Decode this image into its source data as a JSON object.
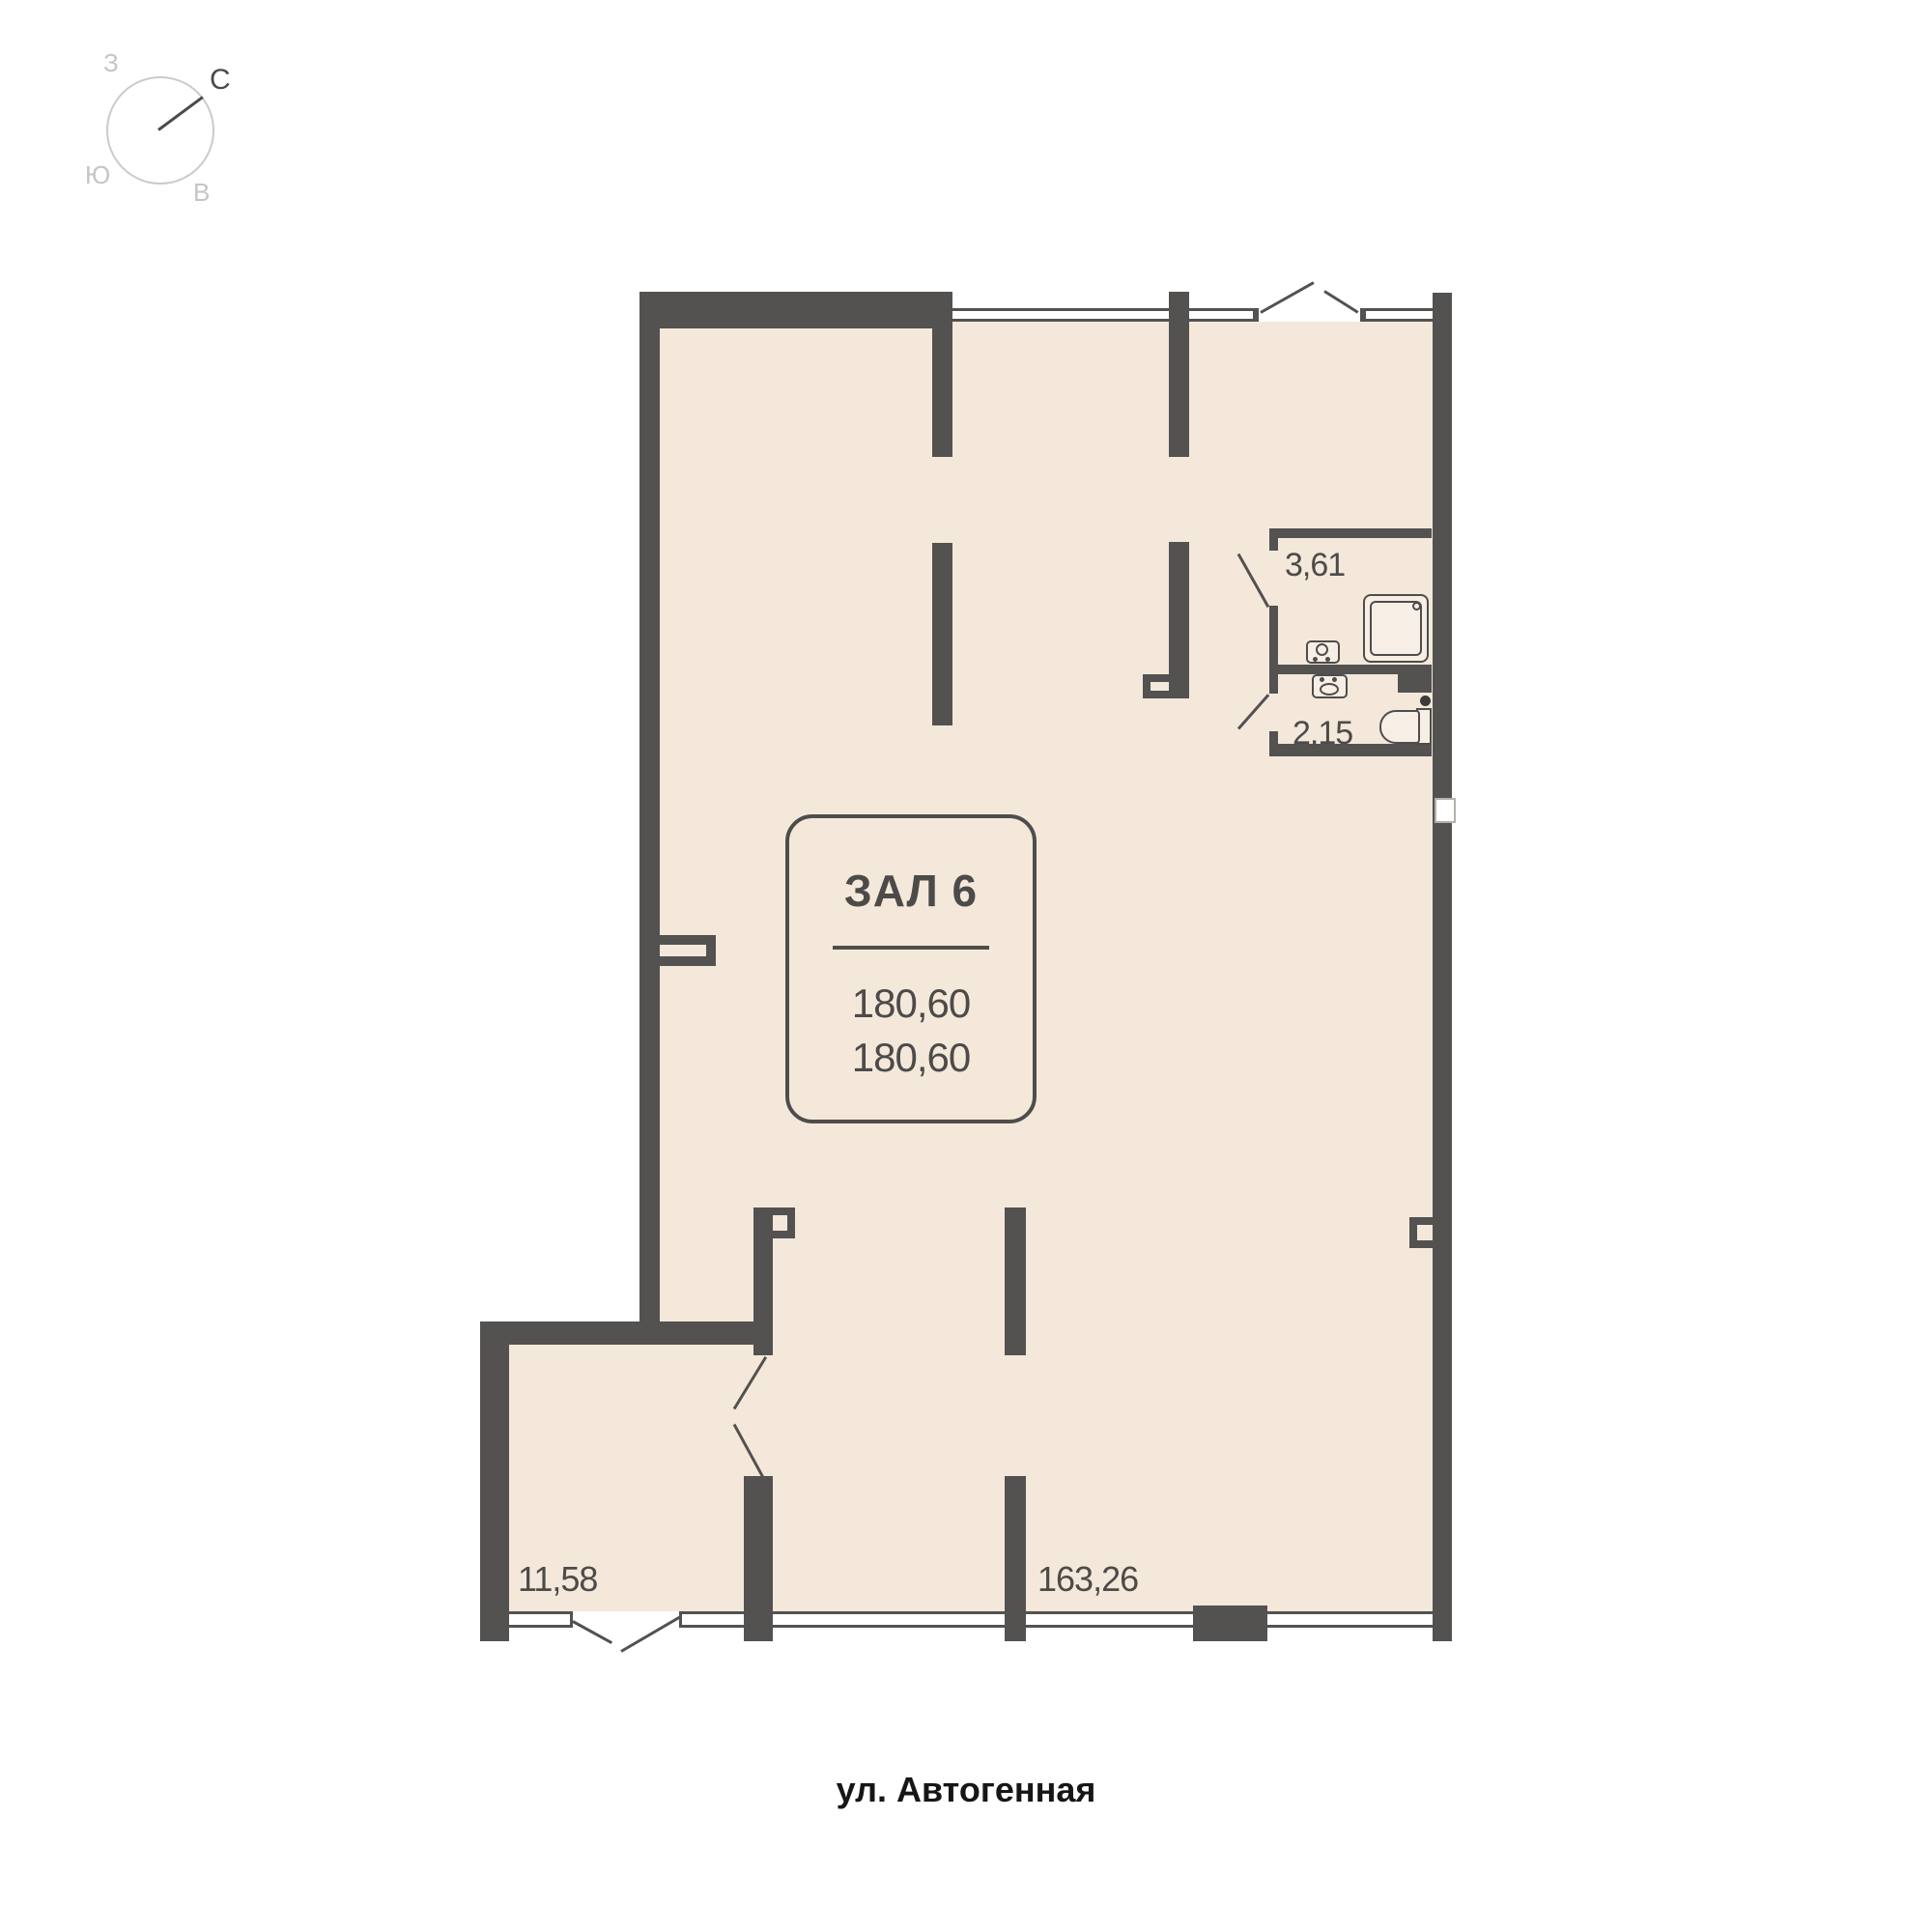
{
  "compass": {
    "north_label": "С",
    "west_label": "З",
    "south_label": "Ю",
    "east_label": "В"
  },
  "unit_card": {
    "title": "ЗАЛ 6",
    "area_line1": "180,60",
    "area_line2": "180,60"
  },
  "areas": {
    "bathroom": "3,61",
    "wc": "2,15",
    "entry_room": "11,58",
    "main_hall": "163,26"
  },
  "street": {
    "name": "ул. Автогенная"
  },
  "colors": {
    "wall": "#535251",
    "floor": "#f4e8db",
    "label_text": "#4c4b49",
    "street_text": "#161616",
    "compass_muted": "#c5c5c5",
    "compass_dark": "#4a4a4a"
  }
}
